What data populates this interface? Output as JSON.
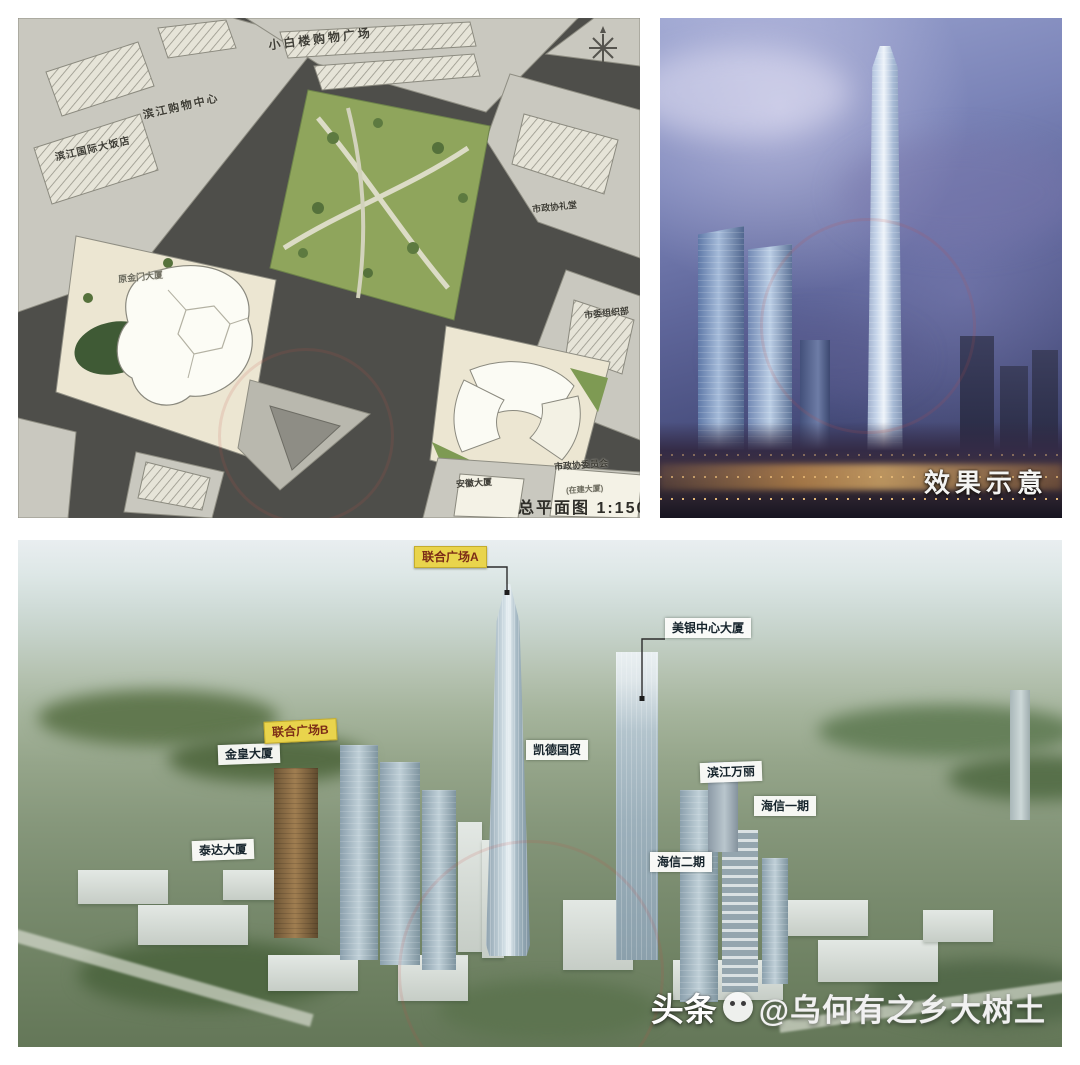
{
  "site_plan": {
    "compass_glyph": "✳",
    "labels": {
      "mall_top": "小白楼购物广场",
      "shopping_center": "滨江购物中心",
      "hotel": "滨江国际大饭店",
      "jinmen": "原金门大厦",
      "auditorium": "市政协礼堂",
      "org_dept": "市委组织部",
      "anhui": "安徽大厦",
      "cppcc": "市政协委员会",
      "cppcc_note": "(在建大厦)",
      "caption": "总平面图  1:1500"
    }
  },
  "render_panel": {
    "caption": "效果示意"
  },
  "aerial": {
    "labels": [
      {
        "text": "联合广场A",
        "style": "yellow"
      },
      {
        "text": "美银中心大厦",
        "style": "white"
      },
      {
        "text": "金皇大厦",
        "style": "white"
      },
      {
        "text": "联合广场B",
        "style": "yellow"
      },
      {
        "text": "凯德国贸",
        "style": "white"
      },
      {
        "text": "滨江万丽",
        "style": "white"
      },
      {
        "text": "海信一期",
        "style": "white"
      },
      {
        "text": "泰达大厦",
        "style": "white"
      },
      {
        "text": "海信二期",
        "style": "white"
      }
    ],
    "watermark": {
      "brand": "头条",
      "handle": "@乌何有之乡大树土"
    }
  },
  "colors": {
    "label_yellow_bg": "#e9d44c",
    "label_yellow_text": "#7c2c17",
    "label_white_bg": "#fcfcfa",
    "plan_road": "#4e4e4a",
    "plan_block": "#c9c8bf",
    "plan_parcel": "#ece6d2",
    "plan_park": "#8fa55c",
    "render_sky": "#6b74ad",
    "aerial_green": "#6e8162"
  }
}
